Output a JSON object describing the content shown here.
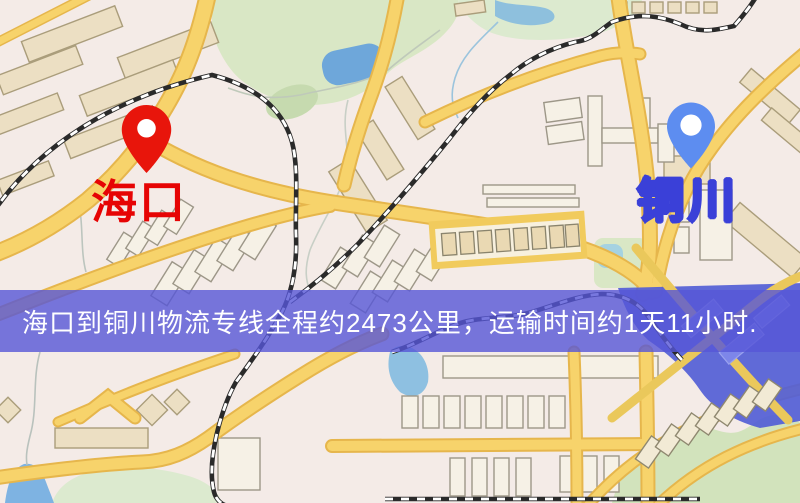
{
  "window": {
    "width": 800,
    "height": 503,
    "kind": "logistics-route-map"
  },
  "map": {
    "markers": [
      {
        "id": "origin",
        "label": "海口",
        "pin_color": "#e8150b",
        "label_color": "#e60404"
      },
      {
        "id": "destination",
        "label": "铜川",
        "pin_color": "#5d8df0",
        "label_color": "#ffffff",
        "label_stroke": "#3a40d8"
      }
    ],
    "banner": {
      "text": "海口到铜川物流专线全程约2473公里，运输时间约1天11小时.",
      "background": "rgba(86,86,215,0.8)",
      "text_color": "#ffffff"
    },
    "route": {
      "origin": "海口",
      "destination": "铜川",
      "distance_km": 2473,
      "duration": "1天11小时"
    }
  }
}
